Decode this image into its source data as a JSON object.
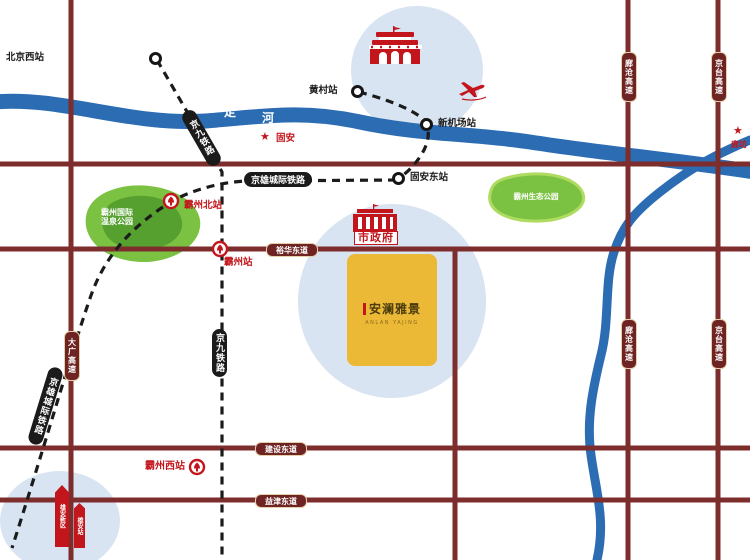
{
  "colors": {
    "road": "#7E2D2D",
    "roadCapsule": "#6F2424",
    "capsuleBorder": "#E4CFA9",
    "river": "#2B6CB3",
    "park": "#7CC242",
    "parkDark": "#55A02E",
    "parkLight": "#AEDB60",
    "rail": "#1B1B1B",
    "halo": "#D8E4F1",
    "red": "#C3161C",
    "projectBg": "#EBB935",
    "projectText": "#4A3A10"
  },
  "river": {
    "name_chars": [
      "永",
      "定",
      "河"
    ]
  },
  "stations": {
    "beijing_west": "北京西站",
    "huangcun": "黄村站",
    "new_airport": "新机场站",
    "guan_east": "固安东站",
    "bazhou_north": "霸州北站",
    "bazhou": "霸州站",
    "bazhou_west": "霸州西站"
  },
  "railways": {
    "jingjiu": "京九铁路",
    "jingxiong": "京雄城际铁路"
  },
  "roads": {
    "yuhua": "裕华东道",
    "jianshe": "建设东道",
    "yijin": "益津东道",
    "daguang": "大广高速",
    "langcang": "廊沧高速",
    "jingtai": "京台高速"
  },
  "parks": {
    "hot_spring_l1": "霸州国际",
    "hot_spring_l2": "温泉公园",
    "eco": "霸州生态公园"
  },
  "cities": {
    "guan": "固安",
    "langfang": "廊坊"
  },
  "landmarks": {
    "city_gov": "市政府",
    "xiongan_1": "雄安新区",
    "xiongan_2": "雄安站"
  },
  "project": {
    "name": "安澜雅景",
    "subtitle": "ANLAN YAJING"
  },
  "icons": {
    "star": "★",
    "plane": "airplane",
    "tiananmen": "tiananmen-gate",
    "rail_station": "china-railway-station"
  }
}
